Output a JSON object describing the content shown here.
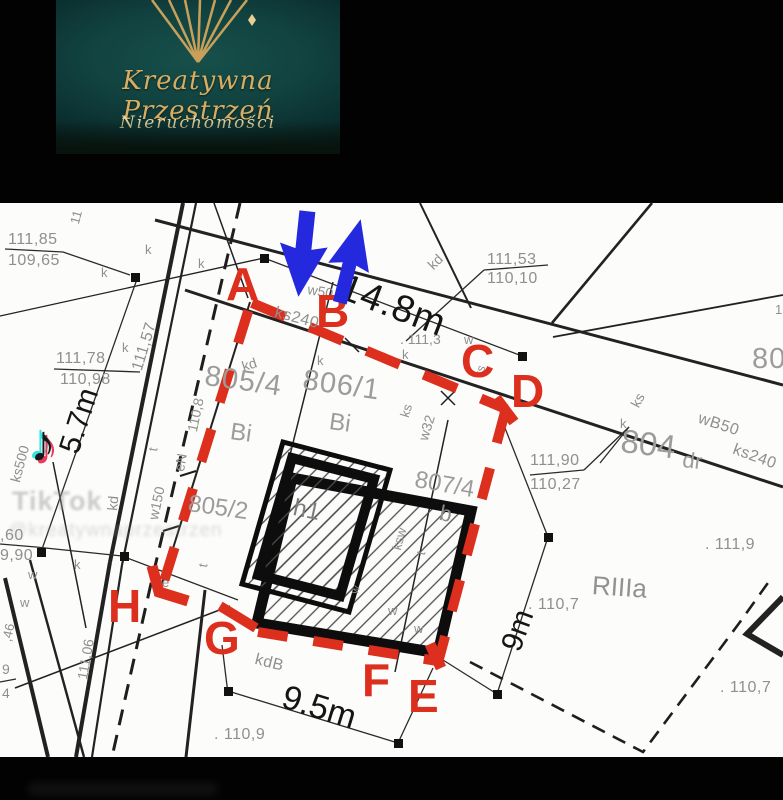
{
  "logo": {
    "title": "Kreatywna Przestrzeń",
    "subtitle": "Nieruchomości"
  },
  "watermark": {
    "app": "TikTok",
    "handle": "@kreatywnaprzestrzen",
    "note_icon": "music-note"
  },
  "colors": {
    "red": "#dd2f1e",
    "blue": "#2429dd",
    "gold": "#d7ad62",
    "map_bg": "#fcfcfa"
  },
  "points": {
    "a": "A",
    "b": "B",
    "c": "C",
    "d": "D",
    "e": "E",
    "f": "F",
    "g": "G",
    "h": "H"
  },
  "dimensions": {
    "top": "14.8m",
    "left": "5.7m",
    "bottom": "9.5m",
    "right": "9m"
  },
  "parcels": {
    "p805_4": "805/4",
    "p806_1": "806/1",
    "p805_2": "805/2",
    "p807_4": "807/4",
    "p804": "804",
    "road_suffix": "dr",
    "p805_clipped": "805",
    "soil_class": "RIIIa",
    "land_use_bi": "Bi",
    "land_use_b": "b",
    "building_h1": "h1",
    "edge_frac_top": "9",
    "edge_frac_bottom": "4"
  },
  "elevations": {
    "e1a": "111,85",
    "e1b": "109,65",
    "e2a": "111,53",
    "e2b": "110,10",
    "e3a": "111,78",
    "e3b": "110,98",
    "e4a": "111,90",
    "e4b": "110,27",
    "e5a": ",60",
    "e5b": "9,90",
    "s111_57": "111,57",
    "s111_3": ". 111,3",
    "s110_8": "110,8",
    "s111_9": ". 111,9",
    "s110_7a": ". 110,7",
    "s110_7b": ". 110,7",
    "s110_9": ". 110,9",
    "s111_06": "111,06",
    "s11": "11",
    "s46": ",46",
    "s1": "1"
  },
  "utilities": {
    "kd": "kd",
    "ks": "ks",
    "ks240": "ks240",
    "ks500": "ks500",
    "wB50": "wB50",
    "w32": "w32",
    "w50": "w50",
    "w150": "w150",
    "ksw": "ksw",
    "kdB": "kdB",
    "eN": "eN",
    "k": "k",
    "w": "w",
    "t": "t",
    "e": "e"
  }
}
